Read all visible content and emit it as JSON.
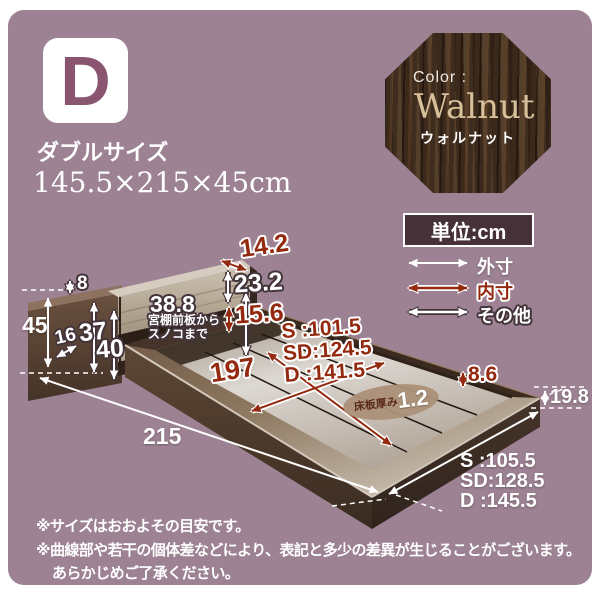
{
  "page": {
    "panel_bg": "#9c8293",
    "accent_red": "#93290f",
    "outline_dark": "#43333a",
    "wood_walnut": "#4a3523"
  },
  "header": {
    "size_letter": "D",
    "size_label": "ダブルサイズ",
    "size_dimensions": "145.5×215×45cm"
  },
  "swatch": {
    "label": "Color :",
    "name": "Walnut",
    "name_ja": "ウォルナット"
  },
  "unit": {
    "label": "単位:cm"
  },
  "legend": {
    "outer": "外寸",
    "inner": "内寸",
    "other": "その他"
  },
  "dims": {
    "shelf_depth": "14.2",
    "headboard_panel_height": "23.2",
    "panel_to_slat_gap": "15.6",
    "shelf_front_to_slat": "38.8",
    "shelf_front_note_1": "宮棚前板から",
    "shelf_front_note_2": "スノコまで",
    "top_edge": "8",
    "total_height": "45",
    "base_height": "16",
    "height_37": "37",
    "height_40": "40",
    "inner_length": "197",
    "inner_width_s": "S :101.5",
    "inner_width_sd": "SD:124.5",
    "inner_width_d": "D :141.5",
    "board_label": "床板厚み",
    "board_value": "1.2",
    "inner_rim_depth": "8.6",
    "rim_height": "19.8",
    "outer_length": "215",
    "outer_width_s": "S :105.5",
    "outer_width_sd": "SD:128.5",
    "outer_width_d": "D :145.5"
  },
  "footnotes": {
    "line1": "※サイズはおおよその目安です。",
    "line2": "※曲線部や若干の個体差などにより、表記と多少の差異が生じることがございます。",
    "line3": "あらかじめご了承ください。"
  }
}
